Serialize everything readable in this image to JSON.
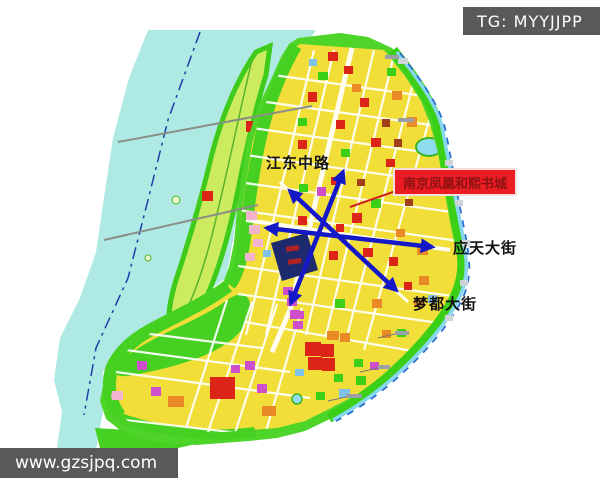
{
  "watermarks": {
    "telegram_badge": "TG: MYYJJPP",
    "website": "www.gzsjpq.com"
  },
  "map": {
    "type": "urban-planning-zoning-map",
    "landmark_label": {
      "text": "南京凤凰和熙书城",
      "bg_color": "#ec1c24",
      "text_color": "#8c1213"
    },
    "road_labels": [
      {
        "id": "jiangdong",
        "text": "江东中路"
      },
      {
        "id": "yingtian",
        "text": "应天大街"
      },
      {
        "id": "mengdu",
        "text": "梦都大街"
      }
    ],
    "palette": {
      "river_cyan": "#aeeae3",
      "island_green_edge": "#3ecb1c",
      "island_fill": "#cdeb5e",
      "land_green": "#4fd42a",
      "urban_yellow": "#f2de39",
      "arrow_blue": "#1518c6",
      "block_red": "#dd2418",
      "block_orange": "#e98a26",
      "block_magenta": "#cf4ecc",
      "block_pink": "#f2b3cd",
      "site_block_navy": "#1d2b6e",
      "badge_gray": "#58595b"
    }
  }
}
